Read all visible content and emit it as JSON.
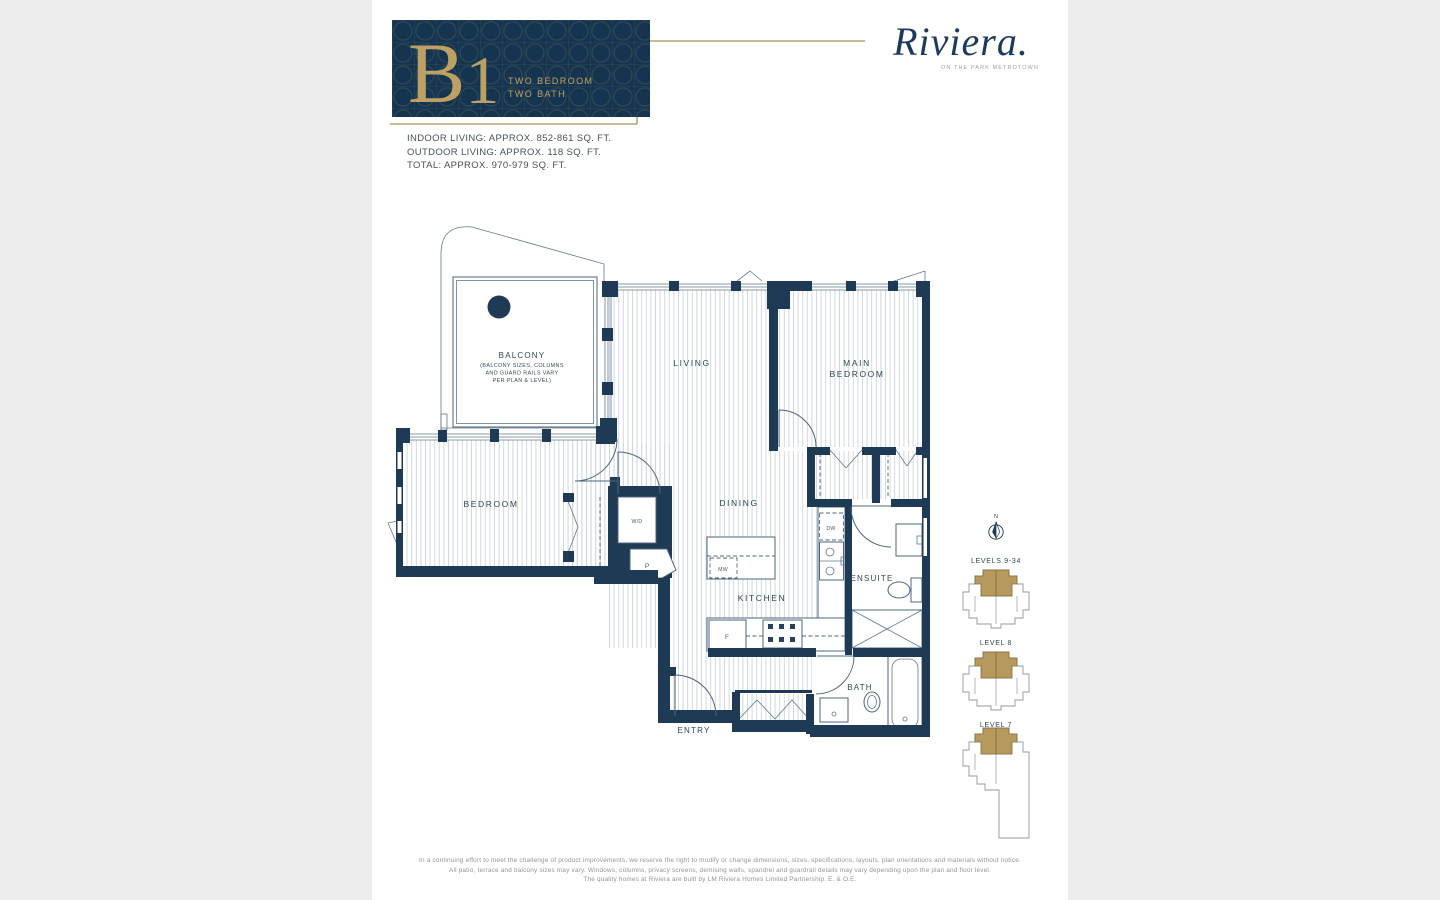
{
  "page": {
    "background": "#ededed",
    "sheet_background": "#ffffff"
  },
  "header": {
    "plan_code_letter": "B",
    "plan_code_number": "1",
    "type_line1": "TWO BEDROOM",
    "type_line2": "TWO BATH",
    "card_color": "#143450",
    "accent_gold": "#b6995c"
  },
  "logo": {
    "brand": "Riviera",
    "period": ".",
    "tagline": "ON THE PARK METROTOWN"
  },
  "stats": {
    "indoor": "INDOOR LIVING: APPROX. 852-861 SQ. FT.",
    "outdoor": "OUTDOOR LIVING: APPROX. 118 SQ. FT.",
    "total": "TOTAL: APPROX. 970-979 SQ. FT."
  },
  "floorplan": {
    "wall_color": "#1e3a55",
    "labels": {
      "living": "LIVING",
      "main_bedroom_1": "MAIN",
      "main_bedroom_2": "BEDROOM",
      "bedroom": "BEDROOM",
      "dining": "DINING",
      "kitchen": "KITCHEN",
      "ensuite": "ENSUITE",
      "bath": "BATH",
      "entry": "ENTRY",
      "balcony": "BALCONY",
      "balcony_note_1": "(BALCONY SIZES, COLUMNS",
      "balcony_note_2": "AND GUARD RAILS VARY",
      "balcony_note_3": "PER PLAN & LEVEL)",
      "washer_dryer": "W/D",
      "pantry": "P",
      "microwave": "MW",
      "dishwasher": "DW",
      "fridge": "F"
    }
  },
  "keyplans": {
    "compass": "N",
    "highlight": "#b6995c",
    "levels": [
      {
        "label": "LEVELS 9-34"
      },
      {
        "label": "LEVEL 8"
      },
      {
        "label": "LEVEL 7"
      }
    ]
  },
  "disclaimer": {
    "line1": "In a continuing effort to meet the challenge of product improvements, we reserve the right to modify or change dimensions, sizes, specifications, layouts, plan orientations and materials without notice.",
    "line2": "All patio, terrace and balcony sizes may vary. Windows, columns, privacy screens, demising walls, spandrel and guardrail details may vary depending upon the plan and floor level.",
    "line3": "The quality homes at Riviera are built by LM Riviera Homes Limited Partnership. E. & O.E."
  }
}
